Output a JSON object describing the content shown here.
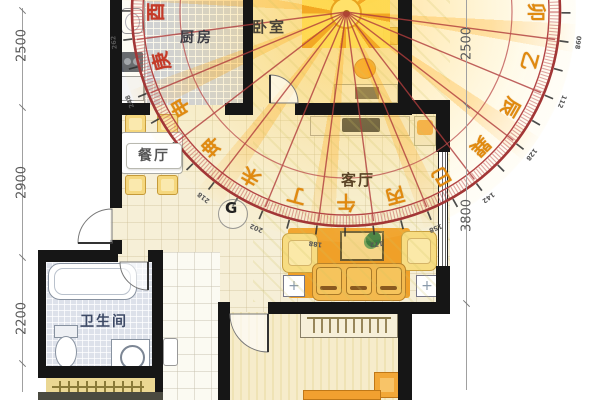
{
  "rooms": {
    "kitchen": "厨房",
    "bedroom": "卧室",
    "dining": "餐厅",
    "living": "客厅",
    "bathroom": "卫生间"
  },
  "dimensions": {
    "left": [
      {
        "value": "2500"
      },
      {
        "value": "2900"
      },
      {
        "value": "2200"
      }
    ],
    "right": [
      {
        "value": "2500"
      },
      {
        "value": "3800"
      }
    ]
  },
  "compass": {
    "marker": "G",
    "mountains": [
      {
        "char": "卯"
      },
      {
        "char": "乙"
      },
      {
        "char": "辰"
      },
      {
        "char": "巽"
      },
      {
        "char": "巳"
      },
      {
        "char": "丙"
      },
      {
        "char": "午"
      },
      {
        "char": "丁"
      },
      {
        "char": "未"
      },
      {
        "char": "坤"
      },
      {
        "char": "申"
      },
      {
        "char": "庚"
      },
      {
        "char": "酉"
      }
    ],
    "degree_labels": [
      "098",
      "112",
      "128",
      "142",
      "158",
      "172",
      "188",
      "202",
      "218",
      "232",
      "248",
      "262"
    ]
  },
  "colors": {
    "ring": "#a23636",
    "radial_line": "#b03c3c",
    "mountain_orange": "#e08a10",
    "mountain_red": "#c53a28",
    "glow": "#ffc830",
    "wall": "#161616",
    "kitchen_tile": "#c9cfdf",
    "bath_tile": "#dde1ea",
    "floor_cream": "#f6efd7",
    "sofa_orange": "#f0a028"
  }
}
